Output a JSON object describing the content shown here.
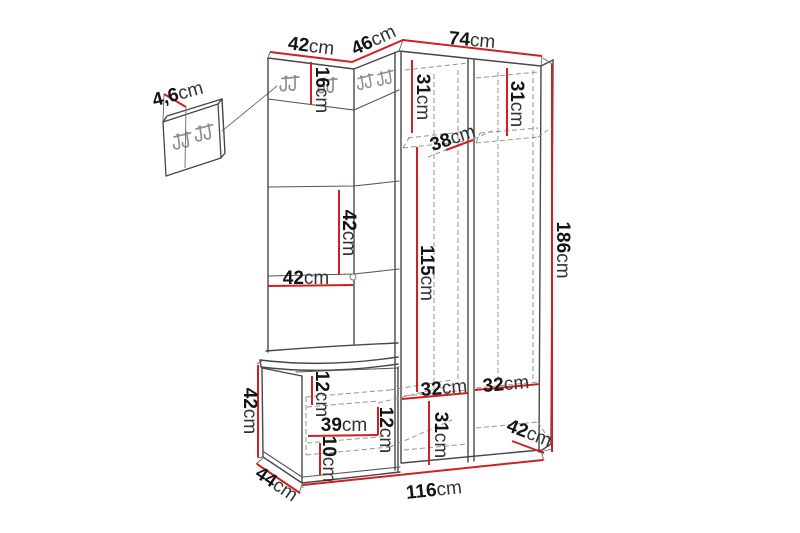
{
  "page": {
    "background_color": "#ffffff"
  },
  "diagram": {
    "type": "furniture-dimension-diagram",
    "subject": "corner hallway wardrobe unit with hook panels, open wardrobe, shoe bench and separate wall hook panel",
    "unit": "cm",
    "colors": {
      "dimension_line": "#d02020",
      "outline": "#474747",
      "hidden_edge_dashed": "#949494",
      "label_text": "#141414",
      "hook_icon": "#8f8f8f",
      "background": "#ffffff"
    },
    "labels": [
      {
        "id": "wall-panel-thickness",
        "value": "4,6",
        "unit": "cm"
      },
      {
        "id": "top-left-width",
        "value": "42",
        "unit": "cm"
      },
      {
        "id": "corner-panel-width",
        "value": "46",
        "unit": "cm"
      },
      {
        "id": "wardrobe-width",
        "value": "74",
        "unit": "cm"
      },
      {
        "id": "hook-panel-height",
        "value": "16",
        "unit": "cm"
      },
      {
        "id": "left-compartment-top",
        "value": "31",
        "unit": "cm"
      },
      {
        "id": "right-compartment-top",
        "value": "31",
        "unit": "cm"
      },
      {
        "id": "shelf-depth",
        "value": "38",
        "unit": "cm"
      },
      {
        "id": "total-height",
        "value": "186",
        "unit": "cm"
      },
      {
        "id": "middle-panel-height",
        "value": "42",
        "unit": "cm"
      },
      {
        "id": "middle-panel-width",
        "value": "42",
        "unit": "cm"
      },
      {
        "id": "compartment-middle-height",
        "value": "115",
        "unit": "cm"
      },
      {
        "id": "bench-height",
        "value": "42",
        "unit": "cm"
      },
      {
        "id": "bench-top-height",
        "value": "12",
        "unit": "cm"
      },
      {
        "id": "bench-inner-width",
        "value": "39",
        "unit": "cm"
      },
      {
        "id": "bench-shelf-height",
        "value": "12",
        "unit": "cm"
      },
      {
        "id": "bench-plinth-height",
        "value": "10",
        "unit": "cm"
      },
      {
        "id": "bench-depth",
        "value": "44",
        "unit": "cm"
      },
      {
        "id": "left-compartment-width",
        "value": "32",
        "unit": "cm"
      },
      {
        "id": "right-compartment-width",
        "value": "32",
        "unit": "cm"
      },
      {
        "id": "left-compartment-bottom",
        "value": "31",
        "unit": "cm"
      },
      {
        "id": "wardrobe-depth",
        "value": "42",
        "unit": "cm"
      },
      {
        "id": "total-width",
        "value": "116",
        "unit": "cm"
      }
    ]
  }
}
